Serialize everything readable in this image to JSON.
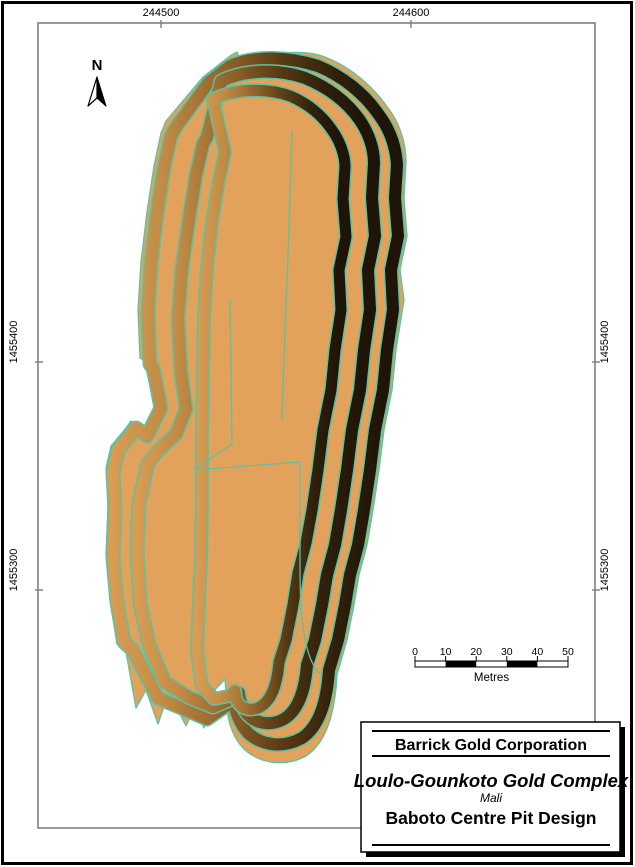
{
  "map": {
    "graticule": {
      "top_labels": [
        {
          "text": "244500"
        },
        {
          "text": "244600"
        }
      ],
      "left_labels": [
        {
          "text": "1455400"
        },
        {
          "text": "1455300"
        }
      ],
      "right_labels": [
        {
          "text": "1455400"
        },
        {
          "text": "1455300"
        }
      ]
    },
    "compass": {
      "label": "N"
    },
    "scale_bar": {
      "ticks": [
        "0",
        "10",
        "20",
        "30",
        "40",
        "50"
      ],
      "unit": "Metres"
    },
    "title_block": {
      "company": "Barrick Gold Corporation",
      "complex": "Loulo-Gounkoto Gold Complex",
      "country": "Mali",
      "title": "Baboto Centre Pit Design"
    }
  },
  "colors": {
    "pit-tan": "#E3A25B",
    "band-tan": "#D89C53",
    "band-brown": "#C08B45",
    "band-mid": "#8F6129",
    "band-dark": "#573A13",
    "band-darker": "#30200B",
    "band-darkest": "#1F1407",
    "crest-teal": "#5BC2A2",
    "frame-gray": "#7E7E7E",
    "ink": "#000000",
    "paper": "#FFFFFF"
  }
}
